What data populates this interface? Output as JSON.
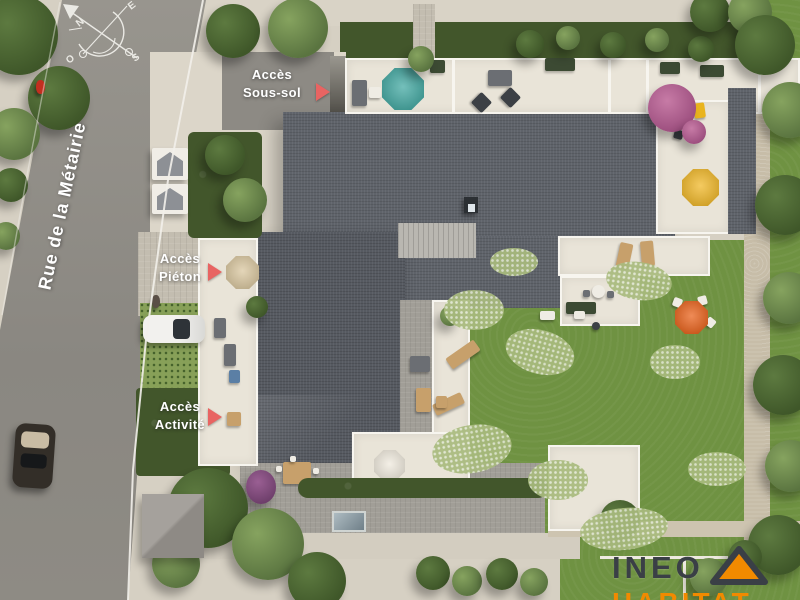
{
  "scene": {
    "street_name": "Rue de la Métairie",
    "compass": {
      "north": "N",
      "east": "E",
      "south": "S",
      "west": "O"
    },
    "access": {
      "sous_sol": {
        "line1": "Accès",
        "line2": "Sous-sol"
      },
      "pieton": {
        "line1": "Accès",
        "line2": "Piéton"
      },
      "activite": {
        "line1": "Accès",
        "line2": "Activité"
      }
    },
    "logo": {
      "brand": "INEO",
      "sub": "HABITAT"
    },
    "icons": {
      "compass_rose": "crossed N-S / E-O axes with arcs and north arrow",
      "access_arrow": "right-pointing red triangle marker",
      "logo_roof": "orange triangle roof with dark outline"
    },
    "colors": {
      "road": "#8f8c85",
      "pavement": "#d6d0c3",
      "lawn": "#6f9242",
      "hedge": "#42562b",
      "roof_slate": "#5f636a",
      "roof_pavers": "#a19e97",
      "terrace": "#e9e4d8",
      "arrow_accent": "#e86462",
      "parasol_teal": "#38a49d",
      "parasol_yellow": "#f0b41c",
      "parasol_orange": "#e8590e",
      "parasol_white": "#efe9dc",
      "logo_orange": "#f18a00",
      "logo_dark": "#3a3f46",
      "label_text": "#ffffff"
    }
  }
}
